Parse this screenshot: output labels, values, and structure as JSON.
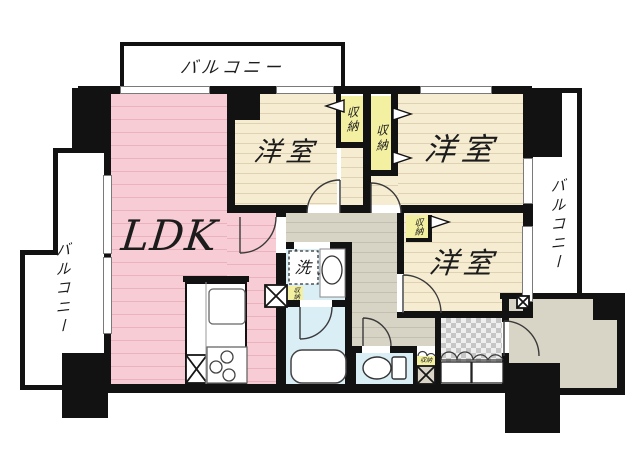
{
  "floorplan": {
    "labels": {
      "balcony_top": "バルコニー",
      "balcony_left": "バルコニー",
      "balcony_right": "バルコニー",
      "ldk": "LDK",
      "bedroom_top_left": "洋室",
      "bedroom_top_right": "洋室",
      "bedroom_bottom_right": "洋室",
      "closet_top_left": "収納",
      "closet_top_center": "収納",
      "closet_bedroom3": "収納",
      "closet_washroom": "収納",
      "closet_hall": "収納",
      "washer": "洗"
    },
    "colors": {
      "wall": "#121212",
      "ldk": "#f8ccd4",
      "ldkLine": "#eab2bc",
      "room": "#f6ecd2",
      "roomLine": "#ded2b2",
      "closet": "#f3f0a2",
      "hall": "#d7d3c5",
      "hallLine": "#c3bfb1",
      "wet": "#daeef6",
      "porch": "#d8d4c6",
      "tileA": "#c6c6c6",
      "tileB": "#efefef"
    }
  }
}
